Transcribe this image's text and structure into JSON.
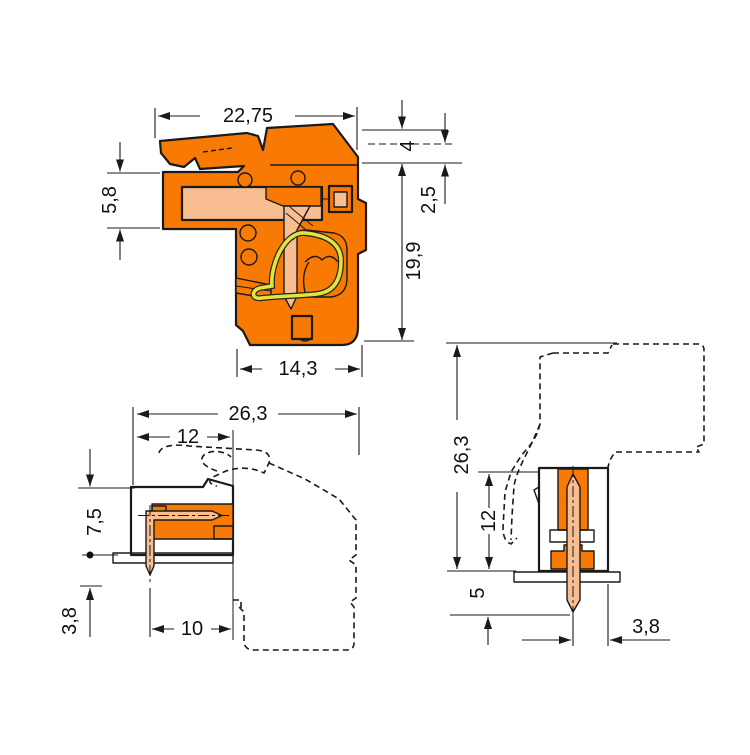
{
  "colors": {
    "housing_orange": "#F87A05",
    "contact_peach": "#F8BE92",
    "spring_yellow": "#E2E43C",
    "pcb_green": "#3DAE49",
    "line_black": "#1A1A1A"
  },
  "views": {
    "side": {
      "name": "female connector side section with locking lever",
      "dims": {
        "total_depth": "22,75",
        "back_step_height": "4",
        "latch_offset": "2,5",
        "body_height": "19,9",
        "entry_height": "5,8",
        "base_depth": "14,3"
      }
    },
    "header_side": {
      "name": "male header side section on PCB",
      "dims": {
        "total_depth": "26,3",
        "shroud_depth": "12",
        "height_above_board": "7,5",
        "pin_below_board": "3,8",
        "pin_to_face": "10"
      }
    },
    "header_vertical": {
      "name": "vertical header section on PCB",
      "dims": {
        "total_height": "26,3",
        "shroud_height": "12",
        "pin_below_board": "5",
        "pin_to_edge": "3,8"
      }
    }
  }
}
